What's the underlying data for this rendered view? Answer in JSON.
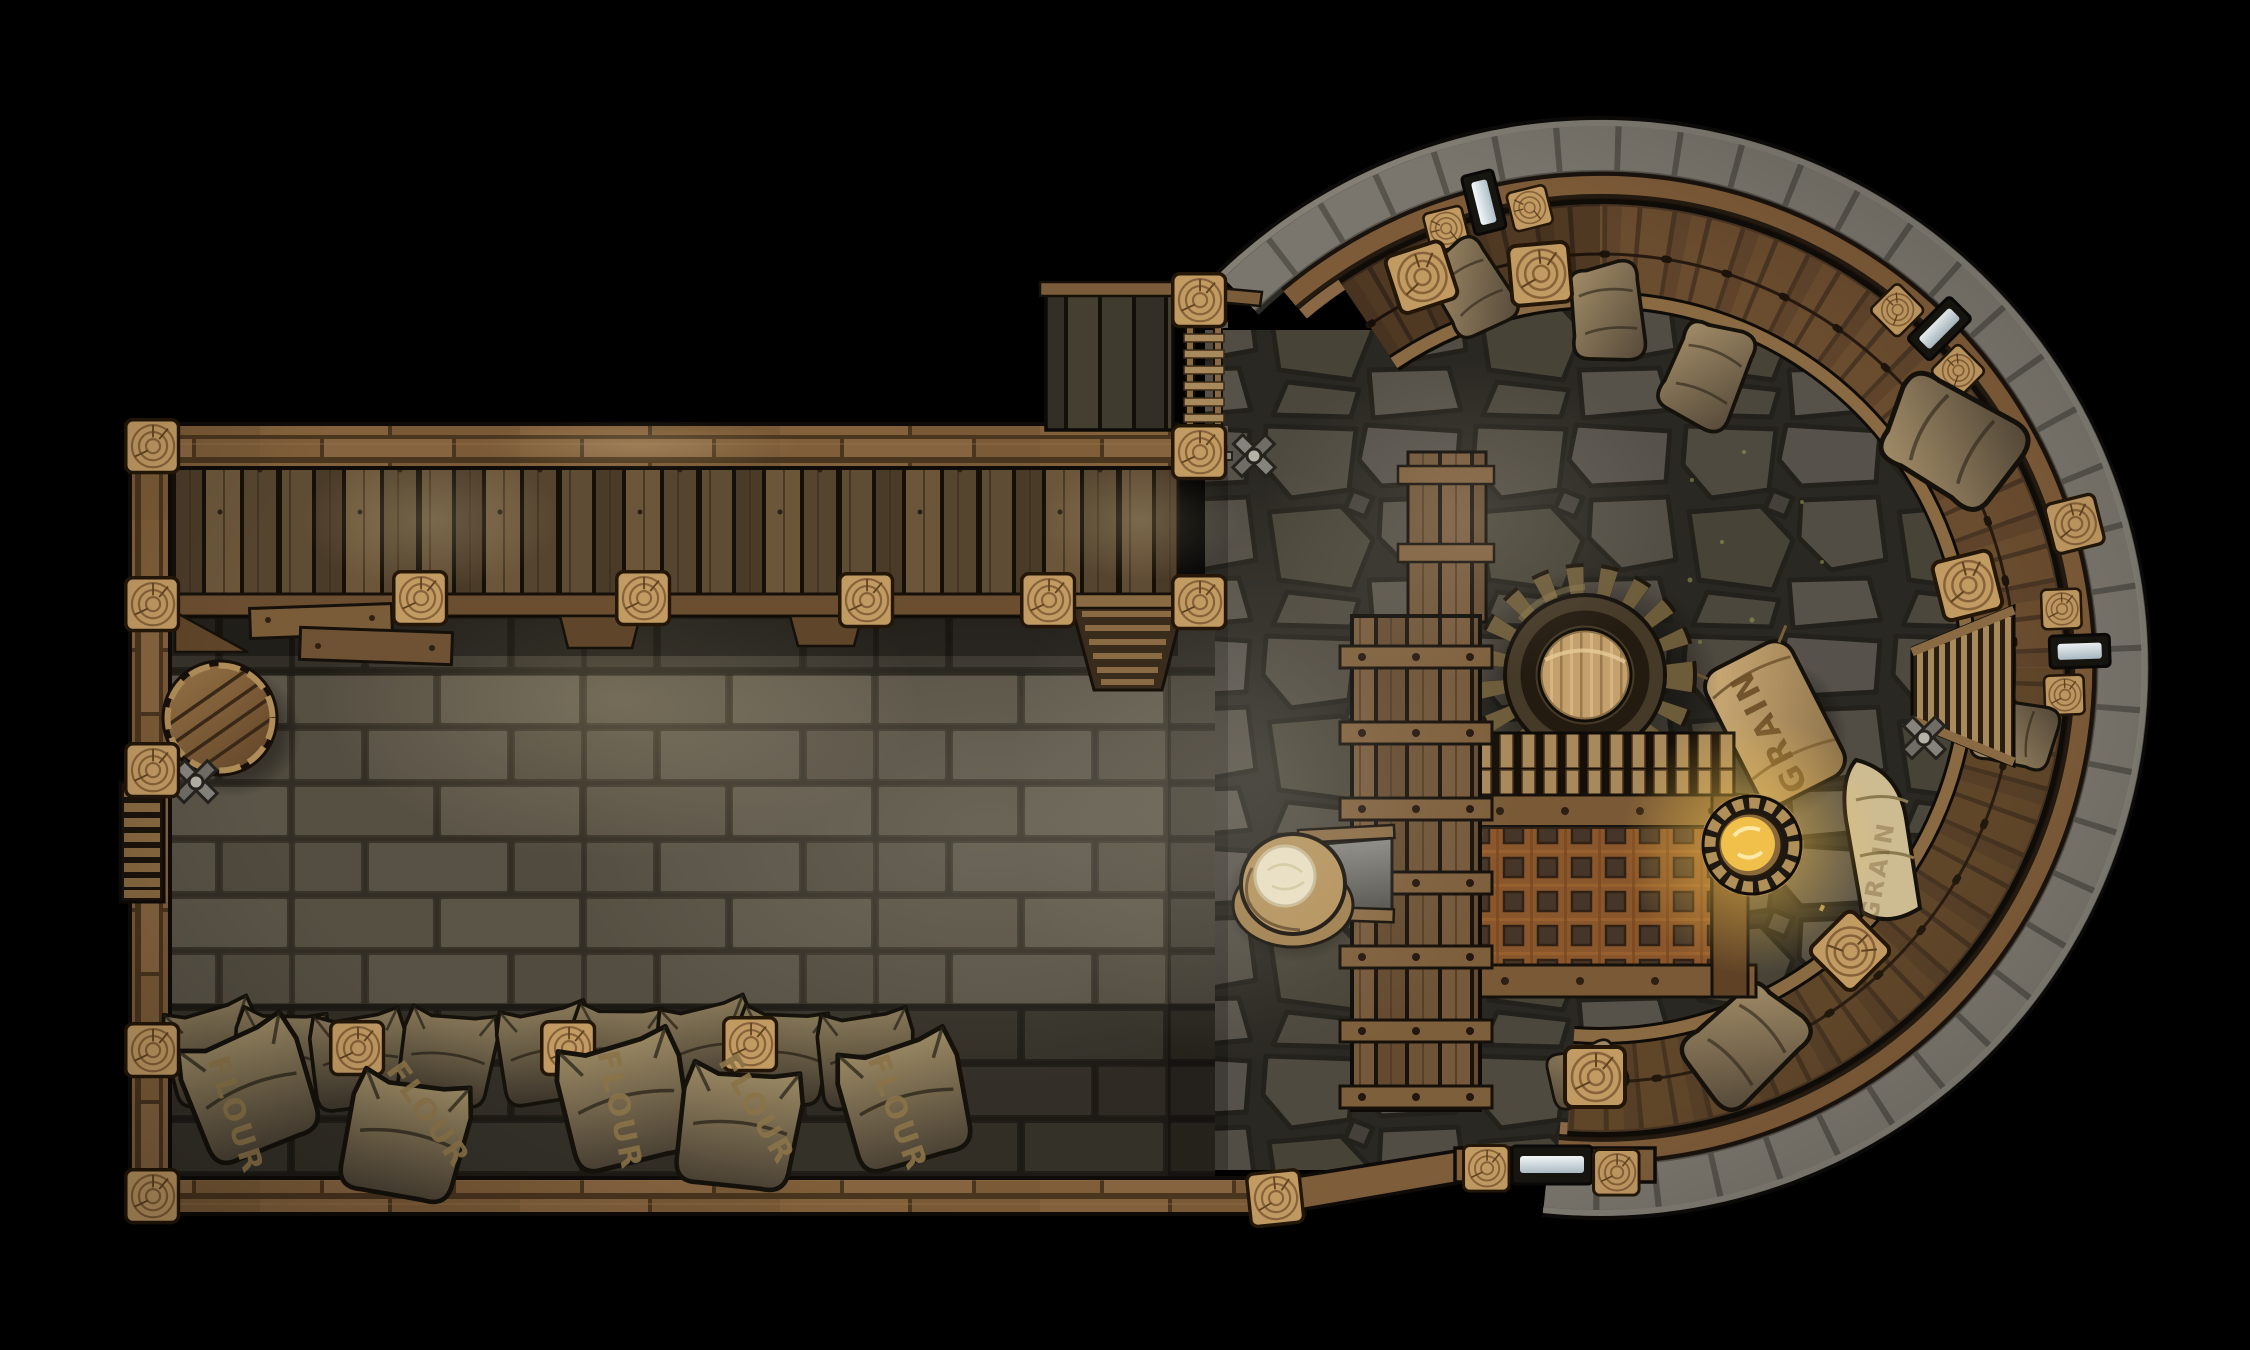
{
  "map": {
    "labels": {
      "flour": "FLOUR",
      "grain": "GRAIN"
    },
    "features": [
      "mill-storage-hall",
      "flour-sack-pile",
      "ale-barrel",
      "loft-shelf",
      "round-tower-room",
      "mill-gear",
      "metal-grate",
      "grain-chute",
      "grain-sack",
      "hanging-lantern",
      "wall-window-slits",
      "tower-stairs",
      "wall-ladder",
      "valve-cranks",
      "support-posts",
      "stone-brick-floor",
      "flagstone-floor",
      "wooden-walkway"
    ],
    "colors": {
      "background": "#000000",
      "wood_frame": "#7d5d3a",
      "wood_post": "#c29b63",
      "wood_dark": "#3c2f1f",
      "loft_plank": "#5a4730",
      "walkway_plank": "#64492e",
      "walkway_rail": "#8a6745",
      "ring_stone": "#76726a",
      "brick_floor": "#544e42",
      "brick_joint": "#332f26",
      "flagstone": "#514c44",
      "flagstone_joint": "#2b2824",
      "gear_body": "#453928",
      "gear_hub": "#c3a06c",
      "grate_rust": "#82542c",
      "grate_hole": "#2e2d2a",
      "lantern_gold": "#f0c04a",
      "lantern_glow": "#ffd978",
      "window_glass": "#dfe7ea",
      "sack_dark": "#57503f",
      "sack_tan": "#c8a870",
      "flour_white": "#ece3c6",
      "label_ink": "#6b4e26"
    }
  }
}
